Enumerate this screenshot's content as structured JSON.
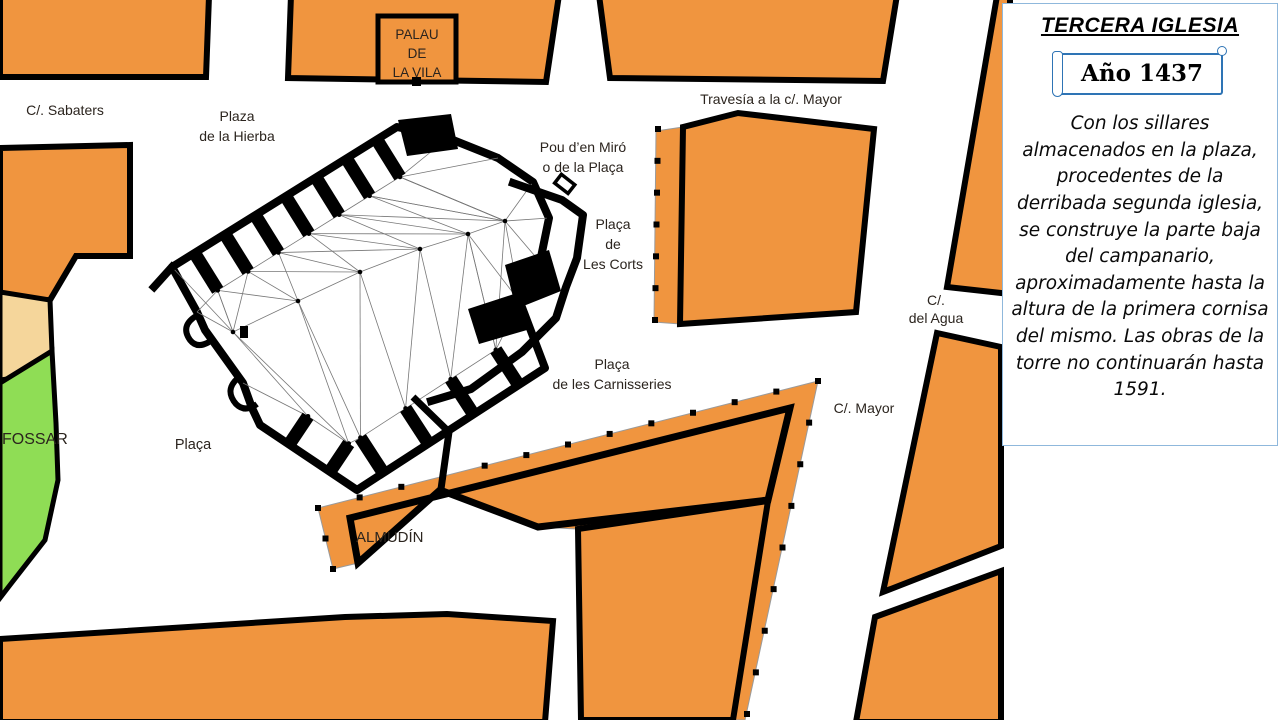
{
  "sidebar": {
    "title": "TERCERA IGLESIA",
    "year_banner": "Año 1437",
    "description": "Con los sillares almacenados en la plaza, procedentes de la derribada segunda iglesia, se construye la parte baja del campanario, aproximadamente hasta la altura de la primera cornisa del mismo. Las obras de la torre no continuarán hasta 1591."
  },
  "map": {
    "labels": [
      {
        "id": "c-sabaters",
        "lines": [
          "C/. Sabaters"
        ],
        "x": 65,
        "y": 115,
        "size": 14,
        "anchor": "middle"
      },
      {
        "id": "plaza-hierba",
        "lines": [
          "Plaza",
          "de la Hierba"
        ],
        "x": 237,
        "y": 121,
        "size": 14,
        "anchor": "middle"
      },
      {
        "id": "palau-de-la-vila",
        "lines": [
          "PALAU",
          "DE",
          "LA VILA"
        ],
        "x": 417,
        "y": 39,
        "size": 13.5,
        "anchor": "middle",
        "lh": 19
      },
      {
        "id": "travesia",
        "lines": [
          "Travesía a la c/. Mayor"
        ],
        "x": 771,
        "y": 104,
        "size": 14,
        "anchor": "middle"
      },
      {
        "id": "pou-den-miro",
        "lines": [
          "Pou d’en Miró",
          "o de la Plaça"
        ],
        "x": 583,
        "y": 152,
        "size": 14,
        "anchor": "middle"
      },
      {
        "id": "placa-les-corts",
        "lines": [
          "Plaça",
          "de",
          "Les Corts"
        ],
        "x": 613,
        "y": 229,
        "size": 14,
        "anchor": "middle"
      },
      {
        "id": "c-del-agua",
        "lines": [
          "C/.",
          "del Agua"
        ],
        "x": 936,
        "y": 305,
        "size": 14,
        "anchor": "middle",
        "lh": 18
      },
      {
        "id": "placa-carnisseries",
        "lines": [
          "Plaça",
          "de les Carnisseries"
        ],
        "x": 612,
        "y": 369,
        "size": 14,
        "anchor": "middle"
      },
      {
        "id": "c-mayor",
        "lines": [
          "C/. Mayor"
        ],
        "x": 864,
        "y": 413,
        "size": 14,
        "anchor": "middle"
      },
      {
        "id": "placa",
        "lines": [
          "Plaça"
        ],
        "x": 193,
        "y": 449,
        "size": 14.5,
        "anchor": "middle"
      },
      {
        "id": "fossar",
        "lines": [
          "FOSSAR"
        ],
        "x": 2,
        "y": 444,
        "size": 16,
        "anchor": "start"
      },
      {
        "id": "almudin",
        "lines": [
          "ALMUDÍN"
        ],
        "x": 356,
        "y": 542,
        "size": 15,
        "anchor": "start"
      }
    ]
  },
  "colors": {
    "block": "#F0953F",
    "plot_tan": "#F5D69B",
    "plot_green": "#8FDD55",
    "outline": "#000000",
    "label": "#2B241E",
    "mesh": "#777777",
    "sidebar_border": "#8FB8DC",
    "banner_border": "#2E74B5"
  }
}
